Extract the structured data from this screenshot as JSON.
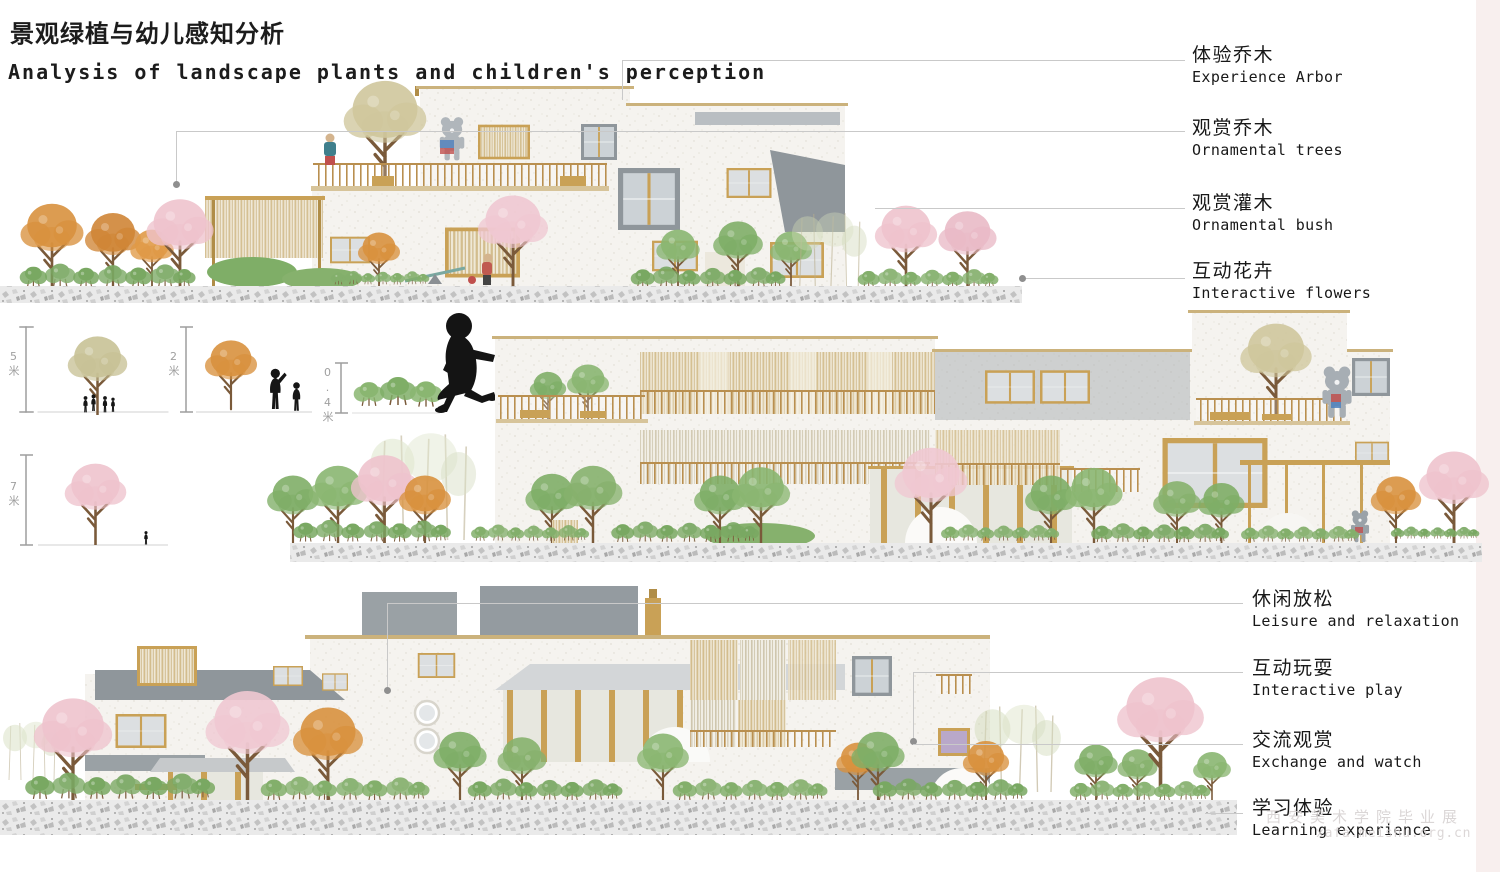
{
  "header": {
    "title_zh": "景观绿植与幼儿感知分析",
    "title_en": "Analysis of landscape plants and children's perception"
  },
  "legend_top": {
    "items": [
      {
        "zh": "体验乔木",
        "en": "Experience Arbor"
      },
      {
        "zh": "观赏乔木",
        "en": "Ornamental trees"
      },
      {
        "zh": "观赏灌木",
        "en": "Ornamental bush"
      },
      {
        "zh": "互动花卉",
        "en": "Interactive flowers"
      }
    ]
  },
  "legend_bottom": {
    "items": [
      {
        "zh": "休闲放松",
        "en": "Leisure and relaxation"
      },
      {
        "zh": "互动玩耍",
        "en": "Interactive play"
      },
      {
        "zh": "交流观赏",
        "en": "Exchange and watch"
      },
      {
        "zh": "学习体验",
        "en": "Learning experience"
      }
    ]
  },
  "scale_markers": {
    "unit": "米",
    "canopy_tree": "5",
    "ornamental_tree": "2",
    "shrub": "0.4",
    "cherry_tree": "7"
  },
  "watermark": {
    "line1": "西安美术学院毕业展",
    "line2": "xafa.meishu.org.cn"
  },
  "colors": {
    "foliage_green": "#84b26e",
    "foliage_orange": "#d8913e",
    "foliage_pink": "#eec3cd",
    "foliage_olive": "#cfc69c",
    "wood_accent": "#c9a156",
    "panel_gray": "#969da2",
    "wall_white": "#f5f3ef",
    "leader_line": "#c9c9c9",
    "silhouette": "#161616"
  }
}
